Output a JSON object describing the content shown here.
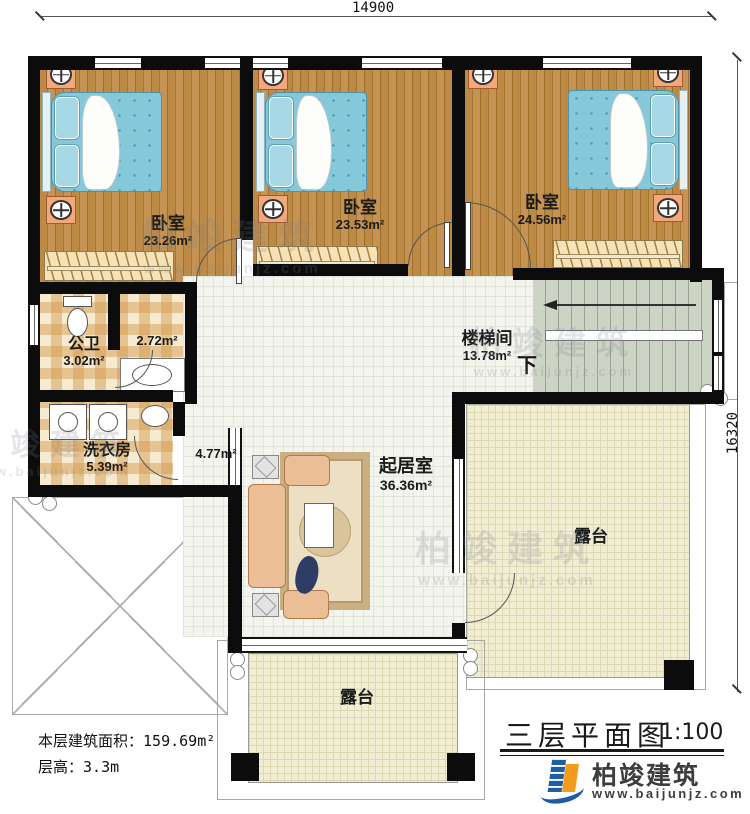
{
  "dimensions": {
    "top": "14900",
    "right": "16320"
  },
  "rooms": {
    "bedroom1": {
      "name": "卧室",
      "area": "23.26m²"
    },
    "bedroom2": {
      "name": "卧室",
      "area": "23.53m²"
    },
    "bedroom3": {
      "name": "卧室",
      "area": "24.56m²"
    },
    "bathroom": {
      "name": "公卫",
      "area": "3.02m²"
    },
    "small_room": {
      "area": "2.72m²"
    },
    "laundry": {
      "name": "洗衣房",
      "area": "5.39m²"
    },
    "corridor": {
      "area": "4.77m²"
    },
    "stairwell": {
      "name": "楼梯间",
      "area": "13.78m²",
      "down_label": "下"
    },
    "living": {
      "name": "起居室",
      "area": "36.36m²"
    },
    "terrace_right": {
      "name": "露台"
    },
    "terrace_bottom": {
      "name": "露台"
    }
  },
  "info": {
    "floor_area_label": "本层建筑面积：",
    "floor_area_value": "159.69m²",
    "height_label": "层高：",
    "height_value": "3.3m"
  },
  "title": {
    "text": "三层平面图",
    "scale": "1:100"
  },
  "brand": {
    "name": "柏竣建筑",
    "url": "www.baijunjz.com"
  },
  "palette": {
    "wall": "#0c0c0c",
    "wood_floor": "#b5823e",
    "tile_check": "#e8c48c",
    "living_tile": "#f4f4ef",
    "stair": "#cdd4c6",
    "terrace": "#f0edd3",
    "bed": "#85c8da",
    "logo_blue": "#1b5ea6",
    "logo_orange": "#f29b1d"
  }
}
